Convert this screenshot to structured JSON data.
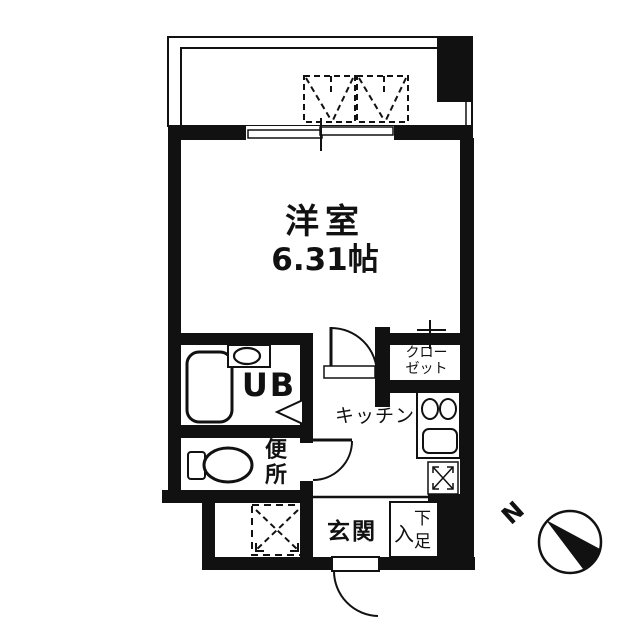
{
  "labels": {
    "main_room_name": "洋室",
    "main_room_size": "6.31帖",
    "kitchen": "キッチン",
    "closet_line1": "クロー",
    "closet_line2": "ゼット",
    "unit_bath": "UB",
    "toilet_char1": "便",
    "toilet_char2": "所",
    "entrance": "玄関",
    "shoe_left": "入",
    "shoe_right_top": "下",
    "shoe_right_bottom": "足",
    "compass_north": "N"
  },
  "colors": {
    "line": "#111111",
    "background": "#ffffff"
  }
}
